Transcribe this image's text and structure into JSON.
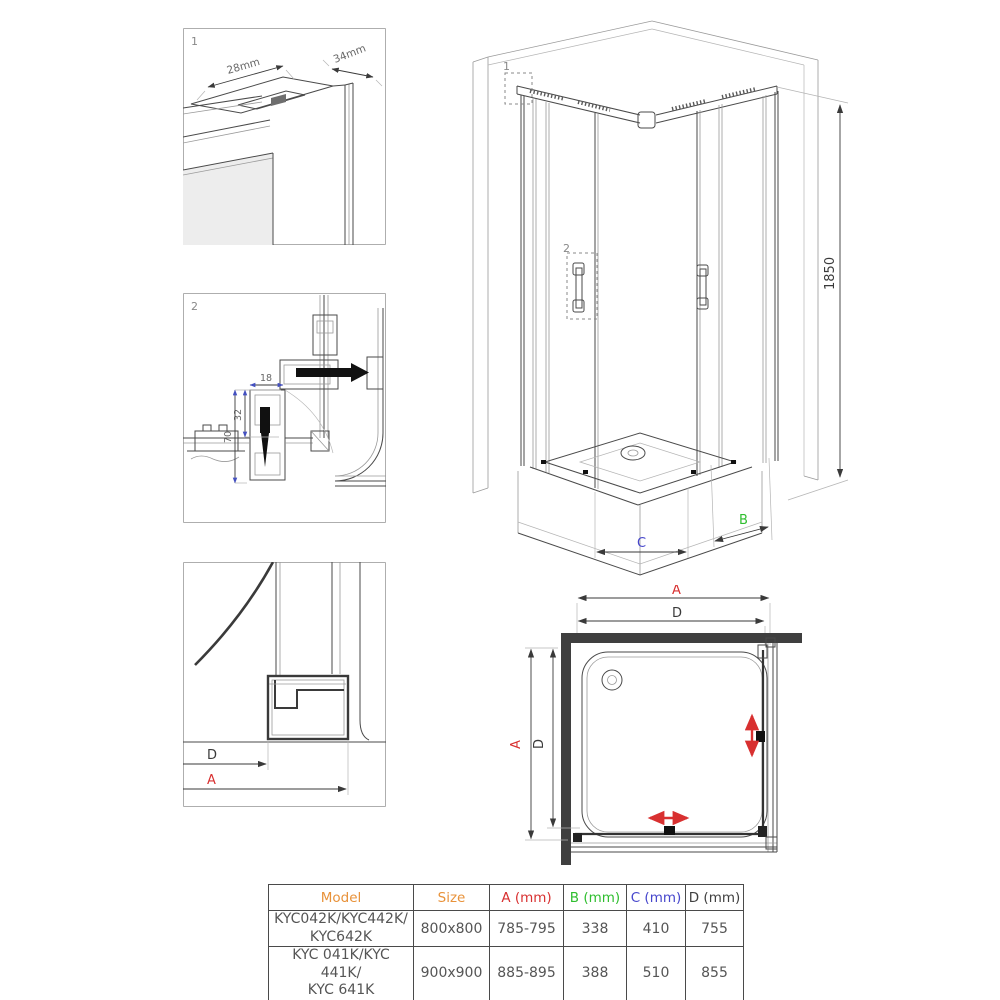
{
  "colors": {
    "accent_red": "#d83030",
    "accent_green": "#2fbe2f",
    "accent_blue": "#4646cc",
    "accent_orange": "#e8923a",
    "wall_fill": "#3f3f3f",
    "line": "#4a4a4a"
  },
  "detail1": {
    "label": "1",
    "dim_width": "28mm",
    "dim_depth": "34mm"
  },
  "detail2": {
    "label": "2",
    "dim_18": "18",
    "dim_32": "32",
    "dim_70": "70"
  },
  "detail3": {
    "dim_d": "D",
    "dim_a": "A"
  },
  "iso": {
    "callout1": "1",
    "callout2": "2",
    "height": "1850",
    "dim_b": "B",
    "dim_c": "C"
  },
  "plan": {
    "dim_a_top": "A",
    "dim_d_top": "D",
    "dim_a_left": "A",
    "dim_d_left": "D"
  },
  "table": {
    "headers": [
      {
        "label": "Model",
        "color": "#e8923a"
      },
      {
        "label": "Size",
        "color": "#e8923a"
      },
      {
        "label": "A (mm)",
        "color": "#d83030"
      },
      {
        "label": "B (mm)",
        "color": "#2fbe2f"
      },
      {
        "label": "C (mm)",
        "color": "#4646cc"
      },
      {
        "label": "D (mm)",
        "color": "#3f3f3f"
      }
    ],
    "rows": [
      {
        "model": "KYC042K/KYC442K/\nKYC642K",
        "size": "800x800",
        "a": "785-795",
        "b": "338",
        "c": "410",
        "d": "755"
      },
      {
        "model": "KYC 041K/KYC 441K/\nKYC 641K",
        "size": "900x900",
        "a": "885-895",
        "b": "388",
        "c": "510",
        "d": "855"
      }
    ]
  }
}
